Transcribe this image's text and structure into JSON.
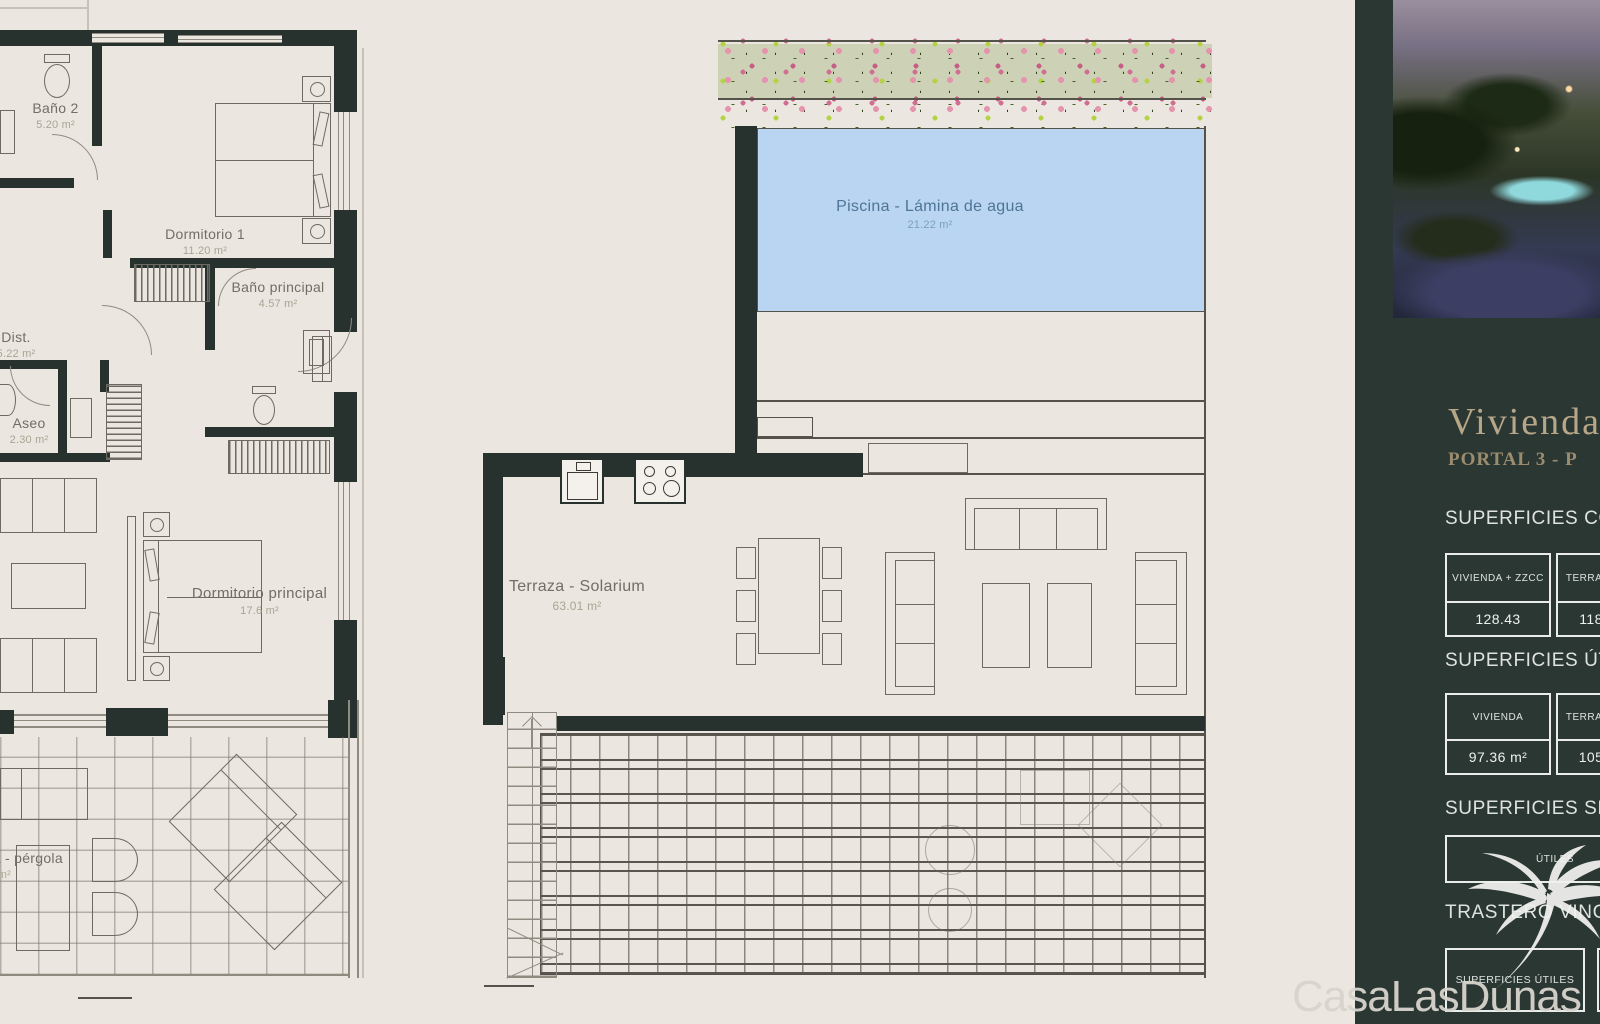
{
  "plan": {
    "rooms": {
      "bano2": {
        "name": "Baño 2",
        "area": "5.20 m²"
      },
      "dorm1": {
        "name": "Dormitorio 1",
        "area": "11.20 m²"
      },
      "banop": {
        "name": "Baño principal",
        "area": "4.57 m²"
      },
      "dist": {
        "name": "Dist.",
        "area": "5.22 m²"
      },
      "aseo": {
        "name": "Aseo",
        "area": "2.30 m²"
      },
      "dormp": {
        "name": "Dormitorio principal",
        "area": "17.6 m²"
      },
      "pergola": {
        "name": "Terraza - pérgola",
        "area": "42.53 m²"
      },
      "solarium": {
        "name": "Terraza - Solarium",
        "area": "63.01 m²"
      },
      "piscina": {
        "name": "Piscina - Lámina de agua",
        "area": "21.22 m²"
      }
    }
  },
  "sidebar": {
    "title": "Vivienda",
    "subtitle": "PORTAL 3 - P",
    "sections": [
      {
        "heading": "SUPERFICIES CONSTRUIDAS",
        "cells": [
          {
            "label": "VIVIENDA + ZZCC",
            "value": "128.43"
          },
          {
            "label": "TERRAZA",
            "value": "118"
          }
        ]
      },
      {
        "heading": "SUPERFICIES ÚTILES",
        "cells": [
          {
            "label": "VIVIENDA",
            "value": "97.36 m²"
          },
          {
            "label": "TERRAZA",
            "value": "105"
          }
        ]
      },
      {
        "heading": "SUPERFICIES SECUNDARIAS",
        "cells": [
          {
            "label": "ÚTILES",
            "value": ""
          }
        ]
      },
      {
        "heading": "TRASTERO VINCULADO",
        "cells": [
          {
            "label": "SUPERFICIES ÚTILES",
            "value": ""
          }
        ]
      }
    ],
    "watermark": "CasaLasDunas",
    "colors": {
      "sidebar_bg": "#2b3733",
      "accent_gold": "#b7a687",
      "wall": "#27322e",
      "pool_water": "#b9d5f1",
      "plan_bg": "#ebe7e0"
    }
  }
}
